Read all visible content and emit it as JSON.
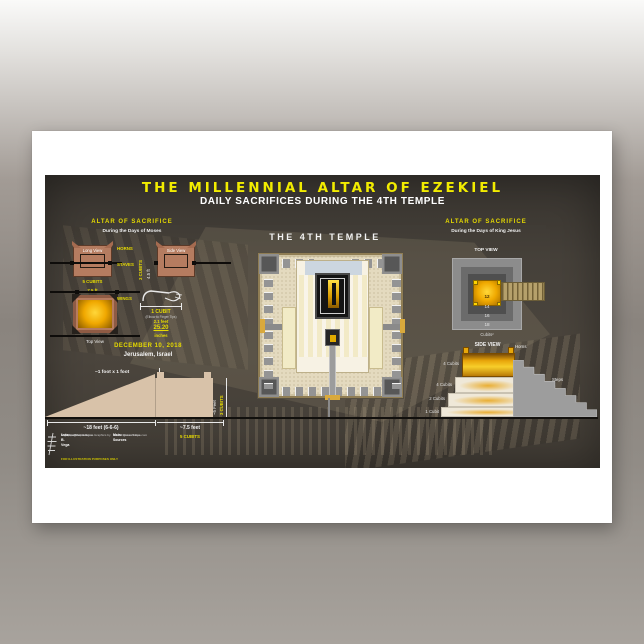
{
  "poster": {
    "title": "THE MILLENNIAL ALTAR OF EZEKIEL",
    "subtitle": "DAILY SACRIFICES DURING THE 4TH TEMPLE",
    "colors": {
      "accent_yellow": "#f2ec00",
      "poster_background": "#423c36",
      "terracotta": "#b57c60",
      "gold": "#f0b400",
      "paper": "#ffffff"
    },
    "left_panel": {
      "heading": "ALTAR OF SACRIFICE",
      "subheading": "During the Days of Moses",
      "long_view_label": "Long View",
      "side_view_label": "Side View",
      "horns_label": "HORNS",
      "staves_label": "STAVES",
      "width_cubits": "5 CUBITS",
      "width_feet": "7.5 ft",
      "height_cubits": "3 CUBITS",
      "height_feet": "4.5 ft",
      "wings_label": "WINGS",
      "top_view_label": "Top View",
      "cubit": {
        "label": "1 CUBIT",
        "sub": "(Elbow to Finger Tips)",
        "feet": "2.1 feet",
        "inches_value": "25.20",
        "inches_unit": "inches"
      },
      "date": "DECEMBER 10, 2018",
      "place": "Jerusalem, Israel"
    },
    "ramp_diagram": {
      "horn_note": "~1 foot x 1 foot",
      "ramp_length": "~18 feet (6-6-6)",
      "altar_width": "~7.5 feet",
      "altar_width_cubits": "5 CUBITS",
      "height_feet": "~5 Feet",
      "height_cubits": "3 CUBITS"
    },
    "center_panel": {
      "heading": "THE 4TH TEMPLE"
    },
    "right_panel": {
      "heading": "ALTAR OF SACRIFICE",
      "subheading": "During the Days of King Jesus",
      "top_view_label": "TOP VIEW",
      "rings": [
        "12",
        "14",
        "16",
        "18"
      ],
      "rings_unit": "Cubits²",
      "side_view_label": "SIDE VIEW",
      "horns_label": "Horns",
      "steps_label": "Steps",
      "tiers": [
        "4 Cubits",
        "4 Cubits",
        "2 Cubits",
        "1 Cubit"
      ]
    },
    "credits": {
      "copyright": "© Composition & Some Graphics by",
      "name": "Luis B. Vega",
      "email": "vegapost@hotmail.com",
      "website": "www.PostScripts.org",
      "note": "FOR ILLUSTRATION PURPOSES ONLY",
      "sources_title": "Main Sources",
      "sources": [
        "BreakingIsraelNews.com",
        "Round Saturn's Eye"
      ]
    }
  }
}
